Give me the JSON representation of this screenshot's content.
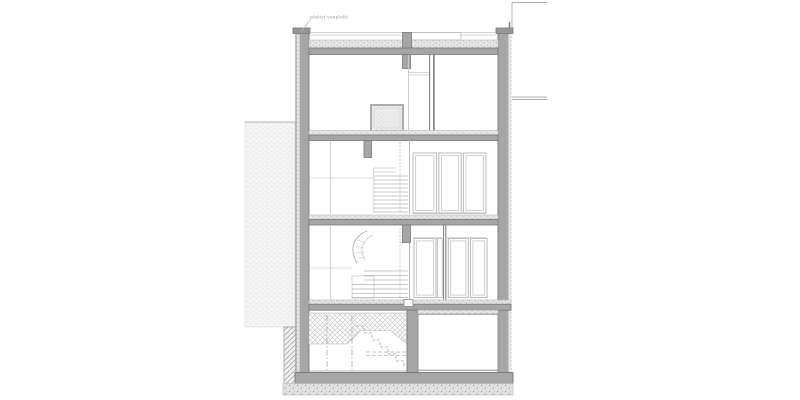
{
  "drawing": {
    "type": "architectural-building-section",
    "annotation": {
      "text": "plekist veeplekk"
    }
  },
  "colors": {
    "paper": "#ffffff",
    "wall": "#a6a6a6",
    "wall-dark": "#979797",
    "outline": "#787878",
    "frame": "#bfbfbf",
    "line-light": "#cccccc",
    "line-mid": "#a8a8a8",
    "stipple-bg": "#e7e7e7",
    "stipple-dot": "#9f9f9f",
    "gravel-bg": "#e3e3e3",
    "neighbor-bg": "#f4f4f4",
    "neighbor-dot": "#dcdcdc",
    "hatch-line": "#c2c2c2",
    "text": "#9a9a9a"
  }
}
